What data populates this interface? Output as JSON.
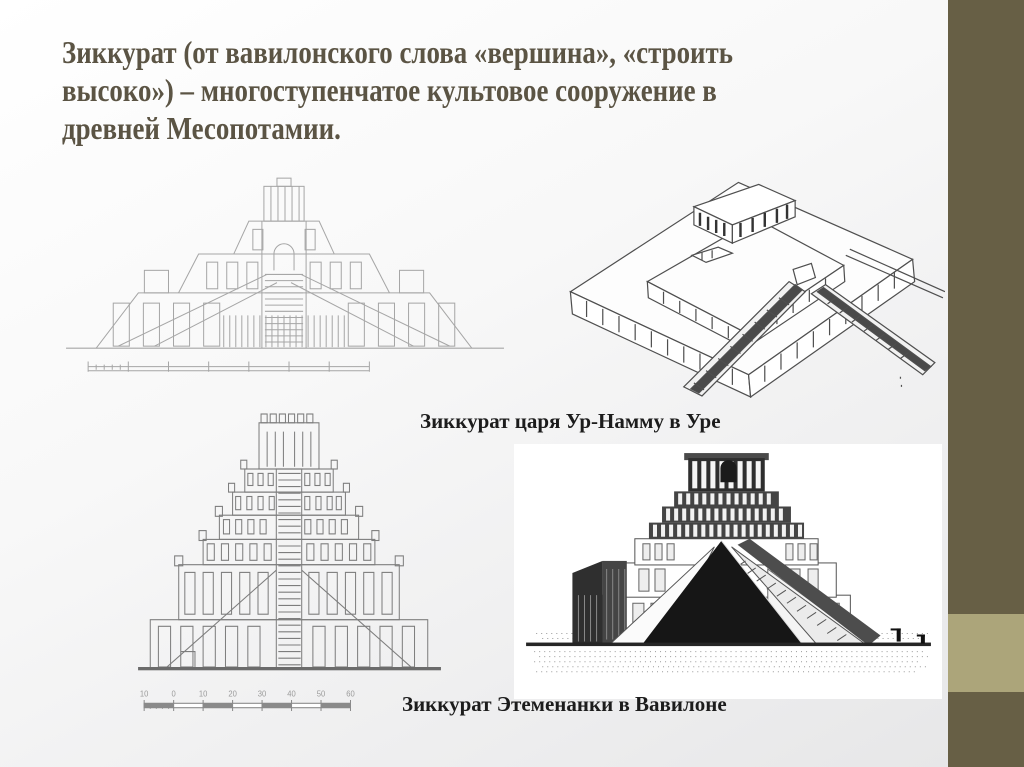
{
  "slide": {
    "title_lines": [
      "Зиккурат (от вавилонского слова «вершина», «строить",
      "высоко») – многоступенчатое культовое сооружение в",
      "древней Месопотамии."
    ],
    "colors": {
      "title_text": "#5b5444",
      "accent_bar_dark": "#675f45",
      "accent_bar_light": "#aca57a",
      "caption_text": "#1c1c1c"
    }
  },
  "figures": {
    "ur_caption": "Зиккурат царя Ур-Намму в Уре",
    "etemenanki_caption": "Зиккурат Этеменанки в Вавилоне",
    "scale_labels": [
      "10",
      "0",
      "10",
      "20",
      "30",
      "40",
      "50",
      "60"
    ]
  }
}
